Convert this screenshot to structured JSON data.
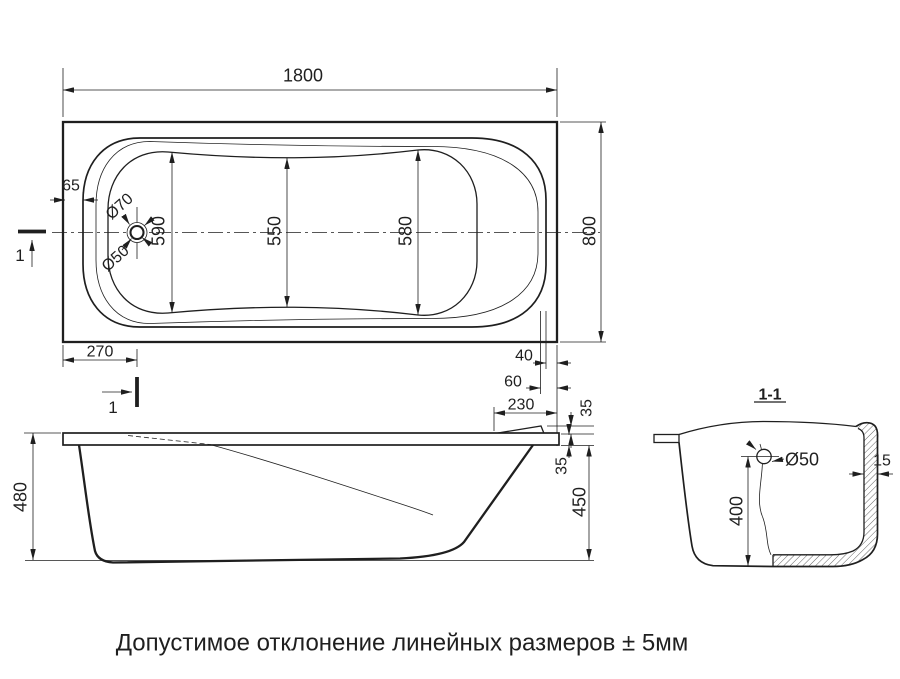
{
  "caption": "Допустимое отклонение линейных размеров ± 5мм",
  "colors": {
    "line": "#1f1f1f",
    "caption": "#8c8c8c",
    "background": "#ffffff"
  },
  "plan": {
    "overall_length": "1800",
    "overall_width": "800",
    "inner_width_left": "590",
    "inner_width_middle": "550",
    "inner_width_right": "580",
    "rim_inset": "65",
    "drain_offset_from_left": "270",
    "rim_end_offset": "40",
    "slope_end_offset": "60",
    "headrest_length": "230",
    "drain_outer_dia": "Ø70",
    "drain_inner_dia": "Ø50"
  },
  "side": {
    "total_height": "480",
    "underrim_height": "450",
    "rim_thickness": "35",
    "headrest_height": "35"
  },
  "section": {
    "title": "1-1",
    "drain_dia": "Ø50",
    "inner_depth": "400",
    "wall_thickness": "15"
  },
  "marks": {
    "section_cut": "1"
  }
}
